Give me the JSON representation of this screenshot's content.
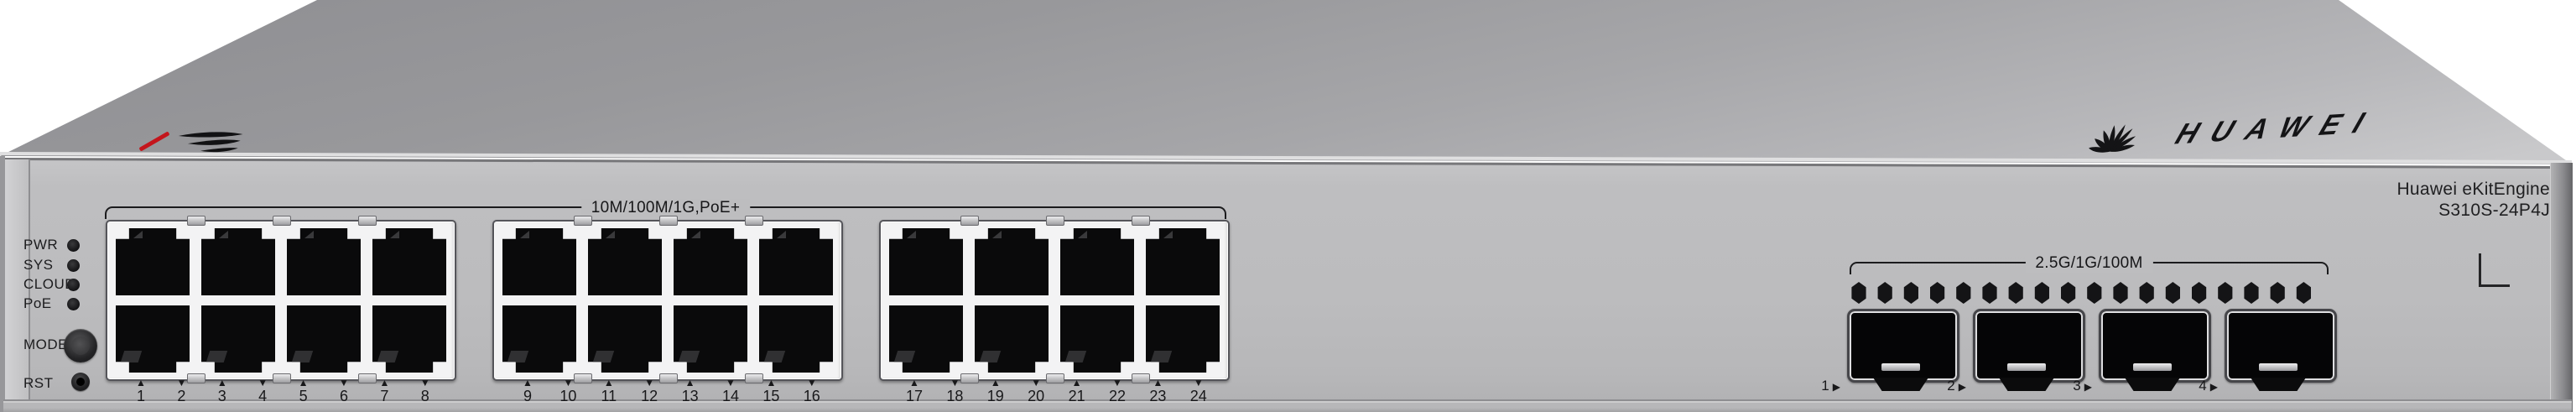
{
  "brand": {
    "logo_text": "HUAWEI"
  },
  "model": {
    "line1": "Huawei eKitEngine",
    "line2": "S310S-24P4J"
  },
  "leds": [
    {
      "label": "PWR"
    },
    {
      "label": "SYS"
    },
    {
      "label": "CLOUD"
    },
    {
      "label": "PoE"
    }
  ],
  "buttons": [
    {
      "label": "MODE"
    },
    {
      "label": "RST"
    }
  ],
  "ports": {
    "group_label": "10M/100M/1G,PoE+",
    "numbers": [
      {
        "n": "1",
        "arrow": "▲"
      },
      {
        "n": "2",
        "arrow": "▼"
      },
      {
        "n": "3",
        "arrow": "▲"
      },
      {
        "n": "4",
        "arrow": "▼"
      },
      {
        "n": "5",
        "arrow": "▲"
      },
      {
        "n": "6",
        "arrow": "▼"
      },
      {
        "n": "7",
        "arrow": "▲"
      },
      {
        "n": "8",
        "arrow": "▼"
      },
      {
        "n": "9",
        "arrow": "▲"
      },
      {
        "n": "10",
        "arrow": "▼"
      },
      {
        "n": "11",
        "arrow": "▲"
      },
      {
        "n": "12",
        "arrow": "▼"
      },
      {
        "n": "13",
        "arrow": "▲"
      },
      {
        "n": "14",
        "arrow": "▼"
      },
      {
        "n": "15",
        "arrow": "▲"
      },
      {
        "n": "16",
        "arrow": "▼"
      },
      {
        "n": "17",
        "arrow": "▲"
      },
      {
        "n": "18",
        "arrow": "▼"
      },
      {
        "n": "19",
        "arrow": "▲"
      },
      {
        "n": "20",
        "arrow": "▼"
      },
      {
        "n": "21",
        "arrow": "▲"
      },
      {
        "n": "22",
        "arrow": "▼"
      },
      {
        "n": "23",
        "arrow": "▲"
      },
      {
        "n": "24",
        "arrow": "▼"
      }
    ]
  },
  "sfp": {
    "group_label": "2.5G/1G/100M",
    "ports": [
      {
        "n": "1",
        "arrow": "▶"
      },
      {
        "n": "2",
        "arrow": "▶"
      },
      {
        "n": "3",
        "arrow": "▶"
      },
      {
        "n": "4",
        "arrow": "▶"
      }
    ]
  },
  "colors": {
    "accent_red": "#c4151c",
    "chassis_gray": "#bdbdbf",
    "jack_black": "#0a0a0b",
    "bezel_white": "#f3f3f4"
  }
}
